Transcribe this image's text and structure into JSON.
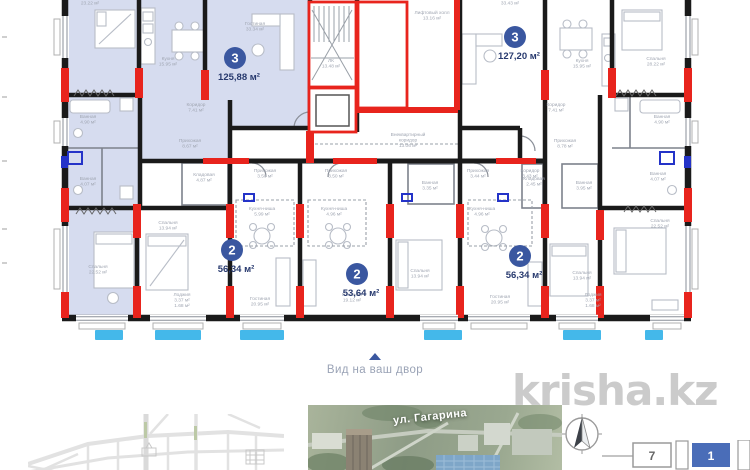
{
  "watermark": "krisha.kz",
  "caption": {
    "text": "Вид на ваш двор"
  },
  "floorplan": {
    "colors": {
      "highlight": "#d6dcef",
      "wall": "#1a1a1a",
      "column_red": "#e8241d",
      "balcony_blue": "#44b8ea",
      "badge": "#3a57a0",
      "area_text": "#27396e",
      "plumbing_blue": "#2433c8"
    },
    "apartments": [
      {
        "badge": "3",
        "area": "125,88 м²",
        "x": 235,
        "y": 58
      },
      {
        "badge": "3",
        "area": "127,20 м²",
        "x": 515,
        "y": 37
      },
      {
        "badge": "2",
        "area": "56,34 м²",
        "x": 232,
        "y": 250
      },
      {
        "badge": "2",
        "area": "53,64 м²",
        "x": 357,
        "y": 274
      },
      {
        "badge": "2",
        "area": "56,34 м²",
        "x": 520,
        "y": 256
      }
    ],
    "rooms": [
      {
        "lines": [
          "Спальня",
          "23.22 м²"
        ],
        "x": 90,
        "y": -1
      },
      {
        "lines": [
          "Гостиная",
          "33.34 м²"
        ],
        "x": 255,
        "y": 25
      },
      {
        "lines": [
          "Кухня",
          "15.95 м²"
        ],
        "x": 168,
        "y": 60
      },
      {
        "lines": [
          "Коридор",
          "7.41 м²"
        ],
        "x": 196,
        "y": 106
      },
      {
        "lines": [
          "Прихожая",
          "8.67 м²"
        ],
        "x": 190,
        "y": 142
      },
      {
        "lines": [
          "Ванная",
          "4.90 м²"
        ],
        "x": 88,
        "y": 118
      },
      {
        "lines": [
          "Ванная",
          "4.07 м²"
        ],
        "x": 88,
        "y": 180
      },
      {
        "lines": [
          "Спальня",
          "22.52 м²"
        ],
        "x": 98,
        "y": 268
      },
      {
        "lines": [
          "Кладовая",
          "4.87 м²"
        ],
        "x": 204,
        "y": 176
      },
      {
        "lines": [
          "Спальня",
          "13.94 м²"
        ],
        "x": 168,
        "y": 224
      },
      {
        "lines": [
          "Прихожая",
          "3.50 м²"
        ],
        "x": 265,
        "y": 172
      },
      {
        "lines": [
          "Кухня-ниша",
          "5.99 м²"
        ],
        "x": 262,
        "y": 210
      },
      {
        "lines": [
          "Гостиная",
          "20.95 м²"
        ],
        "x": 260,
        "y": 300
      },
      {
        "lines": [
          "Лоджия",
          "3.37 м²",
          "1.68 м²"
        ],
        "x": 182,
        "y": 296
      },
      {
        "lines": [
          "Прихожая",
          "3.50 м²"
        ],
        "x": 336,
        "y": 172
      },
      {
        "lines": [
          "Кухня-ниша",
          "4.96 м²"
        ],
        "x": 334,
        "y": 210
      },
      {
        "lines": [
          "Ванная",
          "3.35 м²"
        ],
        "x": 430,
        "y": 184
      },
      {
        "lines": [
          "Спальня",
          "13.94 м²"
        ],
        "x": 420,
        "y": 272
      },
      {
        "lines": [
          "Гостиная",
          "19.12 м²"
        ],
        "x": 352,
        "y": 296
      },
      {
        "lines": [
          "Прихожая",
          "3.44 м²"
        ],
        "x": 478,
        "y": 172
      },
      {
        "lines": [
          "Коридор",
          "3.43 м²"
        ],
        "x": 530,
        "y": 172
      },
      {
        "lines": [
          "Кухня-ниша",
          "4.96 м²"
        ],
        "x": 482,
        "y": 210
      },
      {
        "lines": [
          "Гостиная",
          "20.95 м²"
        ],
        "x": 500,
        "y": 298
      },
      {
        "lines": [
          "Спальня",
          "13.94 м²"
        ],
        "x": 582,
        "y": 274
      },
      {
        "lines": [
          "Лоджия",
          "3.37 м²",
          "1.68 м²"
        ],
        "x": 593,
        "y": 296
      },
      {
        "lines": [
          "Гостиная",
          "33.43 м²"
        ],
        "x": 510,
        "y": -1
      },
      {
        "lines": [
          "Кухня",
          "15.95 м²"
        ],
        "x": 582,
        "y": 62
      },
      {
        "lines": [
          "Спальня",
          "28.22 м²"
        ],
        "x": 656,
        "y": 60
      },
      {
        "lines": [
          "Коридор",
          "7.41 м²"
        ],
        "x": 556,
        "y": 106
      },
      {
        "lines": [
          "Прихожая",
          "8.78 м²"
        ],
        "x": 565,
        "y": 142
      },
      {
        "lines": [
          "Кладовая",
          "2.45 м²"
        ],
        "x": 534,
        "y": 180
      },
      {
        "lines": [
          "Ванная",
          "3.95 м²"
        ],
        "x": 584,
        "y": 184
      },
      {
        "lines": [
          "Ванная",
          "4.90 м²"
        ],
        "x": 662,
        "y": 118
      },
      {
        "lines": [
          "Ванная",
          "4.07 м²"
        ],
        "x": 658,
        "y": 175
      },
      {
        "lines": [
          "Спальня",
          "22.52 м²"
        ],
        "x": 660,
        "y": 222
      },
      {
        "lines": [
          "ЛК",
          "13.48 м²"
        ],
        "x": 331,
        "y": 62
      },
      {
        "lines": [
          "Лифтовый холл",
          "13.16 м²"
        ],
        "x": 432,
        "y": 14
      },
      {
        "lines": [
          "Внеквартирный",
          "коридор",
          "13.06 м²"
        ],
        "x": 408,
        "y": 136
      }
    ]
  },
  "bottom": {
    "street_label": "ул. Гагарина",
    "scheme_boxes": [
      "7",
      "1"
    ]
  }
}
